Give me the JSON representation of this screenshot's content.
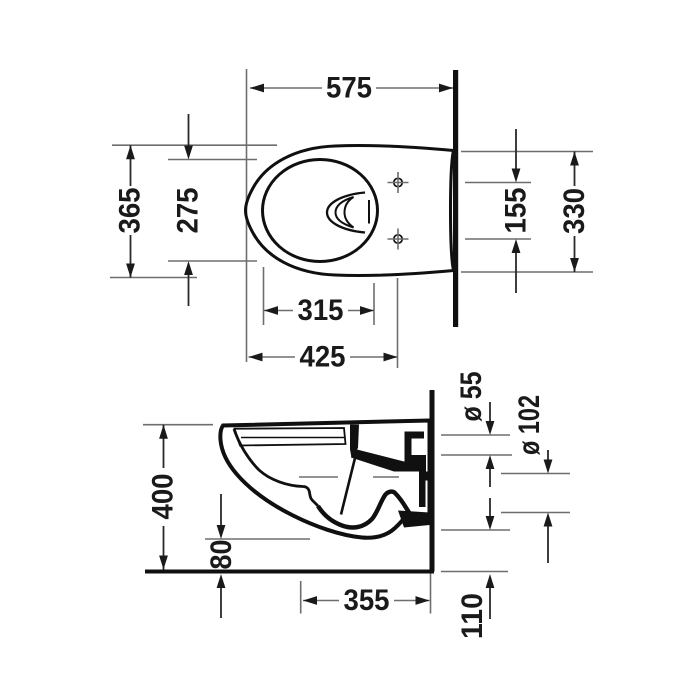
{
  "drawing": {
    "type": "technical-dimension-drawing",
    "subject": "wall-hung toilet, top view and side section view",
    "background": "#ffffff",
    "line_color": "#101010",
    "dimension_line_color": "#6e6e6e",
    "text_color": "#1a1a1a"
  },
  "top_view": {
    "overall_length": "575",
    "overall_width": "365",
    "inner_bowl_width": "275",
    "fixing_hole_spacing": "155",
    "rear_width": "330",
    "inner_bowl_length": "315",
    "front_length": "425"
  },
  "side_view": {
    "height": "400",
    "underside_clearance": "80",
    "projection": "355",
    "outlet_offset": "110",
    "inlet_diameter": "ø 55",
    "outlet_diameter": "ø 102"
  }
}
